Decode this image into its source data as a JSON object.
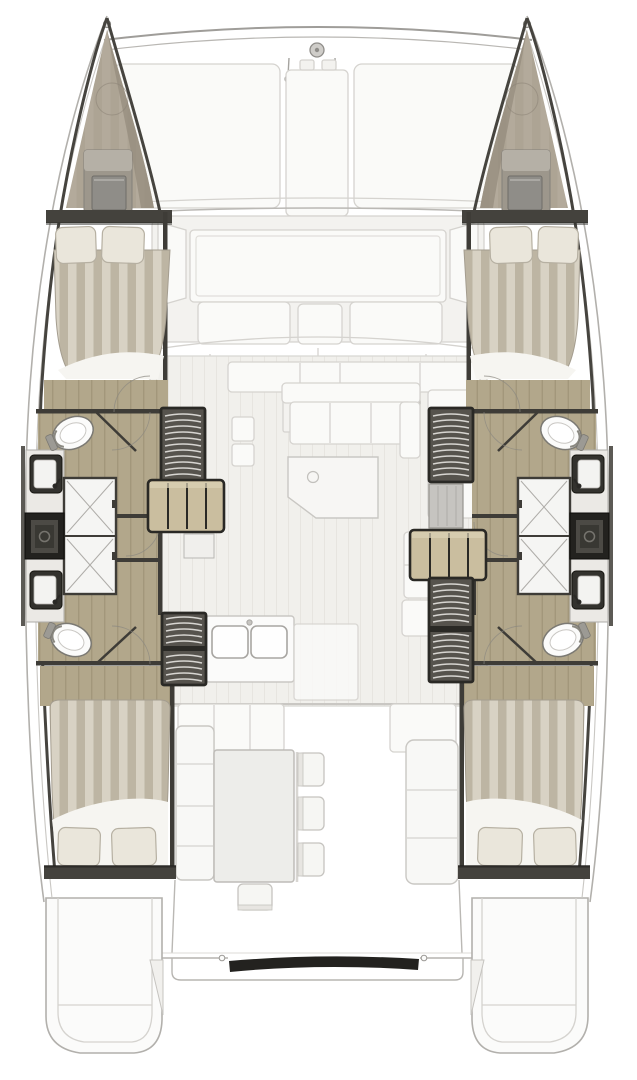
{
  "meta": {
    "type": "boat-floorplan",
    "subject": "catamaran accommodation and deck plan, top-down view",
    "canvas": {
      "width": 637,
      "height": 1080
    }
  },
  "colors": {
    "background": "#ffffff",
    "hull_skin": "#b2b0ac",
    "hull_skin_light": "#c9c7c3",
    "ghost_fill": "#f3f2ef",
    "ghost_fill_bright": "#fafaf8",
    "ghost_stroke": "#d5d3cf",
    "ghost_stroke_dark": "#bab8b4",
    "floor_ghost": "#f1f0ec",
    "floor_ghost_line": "#e7e5e0",
    "wall": "#3e3c37",
    "wall_edge": "#46443f",
    "bar": "#44423d",
    "wood": "#b2a78b",
    "wood_line": "#a2977b",
    "steps": "#cabe9f",
    "stair_bg": "#56534d",
    "stair_rung": "#d7d5d1",
    "stair_frame": "#2a2925",
    "bed_light": "#d8d2c4",
    "bed_dark": "#bdb5a3",
    "bed_edge": "#a49d8f",
    "pillow": "#eae6db",
    "pillow_edge": "#b6b0a2",
    "sheet": "#f6f5f1",
    "bow_fill": "#a89f90",
    "bow_shade": "#958c7d",
    "hatch": "#9d978c",
    "hatch_top": "#b5b0a6",
    "hatch_inner": "#8f8d88",
    "white_room": "#ebe9e5",
    "shower_floor": "#f5f5f3",
    "shower_line": "#aeaca8",
    "fixture_white": "#fbfbfa",
    "fixture_rim": "#7b7973",
    "dark_box": "#23221f",
    "dark_box_inner": "#4c4a45",
    "stern_bar": "#23221f",
    "tan_appliance": "#dcd7cd",
    "door_arc": "#8a8780"
  },
  "components": {
    "bow": [
      "port-bow-peak",
      "starboard-bow-peak",
      "forward-crossbeam",
      "forestay-fitting",
      "bridle-hooks"
    ],
    "foredeck": [
      "deck-panel-left",
      "deck-panel-center",
      "deck-panel-right",
      "forward-cockpit-well",
      "forward-bench-cushions"
    ],
    "port_hull": [
      "forward-double-bed",
      "pillows",
      "forward-head-toilet",
      "sinks",
      "shower-stalls",
      "storage-locker",
      "companionway-stairs",
      "wooden-steps",
      "aft-head-toilet",
      "aft-double-bed"
    ],
    "starboard_hull": [
      "forward-double-bed",
      "pillows",
      "forward-head-toilet",
      "sinks",
      "shower-stalls",
      "storage-locker",
      "companionway-stairs",
      "wooden-steps",
      "aft-head-toilet",
      "aft-double-bed"
    ],
    "salon": [
      "front-counter",
      "appliances",
      "sofa",
      "salon-table",
      "side-galley-units",
      "galley-island-double-sink"
    ],
    "aft_cockpit": [
      "port-bench",
      "dining-table",
      "chairs",
      "starboard-bench"
    ],
    "stern": [
      "port-transom-steps",
      "starboard-transom-steps",
      "aft-rail",
      "stern-platform-bar"
    ]
  },
  "counts": {
    "cabins": 4,
    "toilets": 4,
    "shower_stalls": 4,
    "companionway_stair_sets": 4,
    "cockpit_chairs": 4
  }
}
